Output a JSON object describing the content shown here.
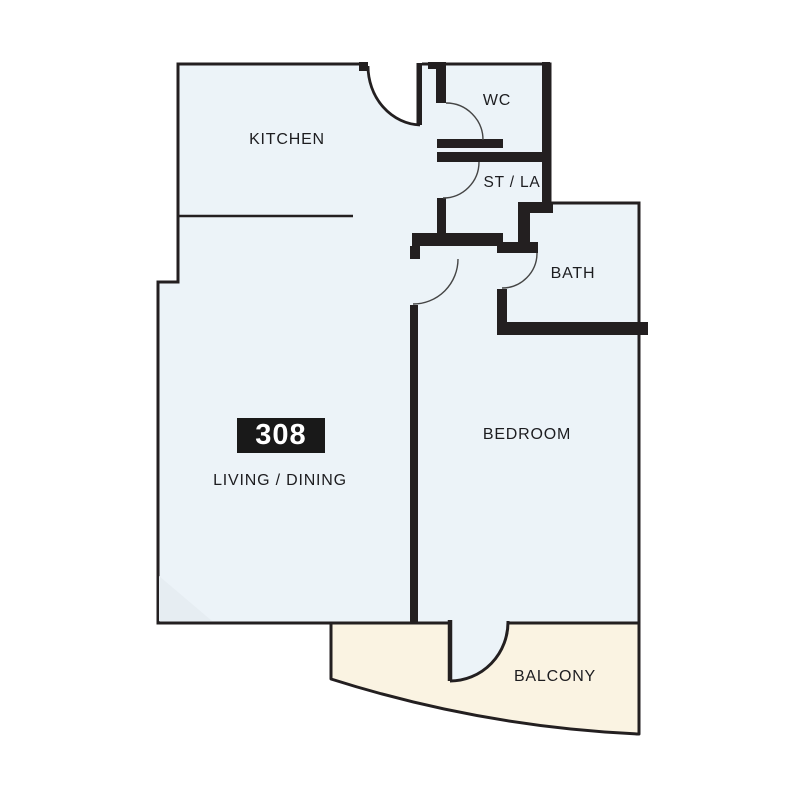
{
  "floor_plan": {
    "unit_badge": {
      "number": "308"
    },
    "labels": {
      "kitchen": "KITCHEN",
      "wc": "WC",
      "st_la": "ST / LA",
      "bath": "BATH",
      "bedroom": "BEDROOM",
      "living_dining": "LIVING / DINING",
      "balcony": "BALCONY"
    },
    "colors": {
      "room_fill": "#ecf3f8",
      "balcony_fill": "#faf3e2",
      "wall": "#231f20",
      "door_arc": "#454545",
      "corner_shade": "#e6edf2",
      "badge_bg": "#191919",
      "badge_text": "#ffffff",
      "label_text": "#1d1d20",
      "page_bg": "#ffffff"
    }
  }
}
